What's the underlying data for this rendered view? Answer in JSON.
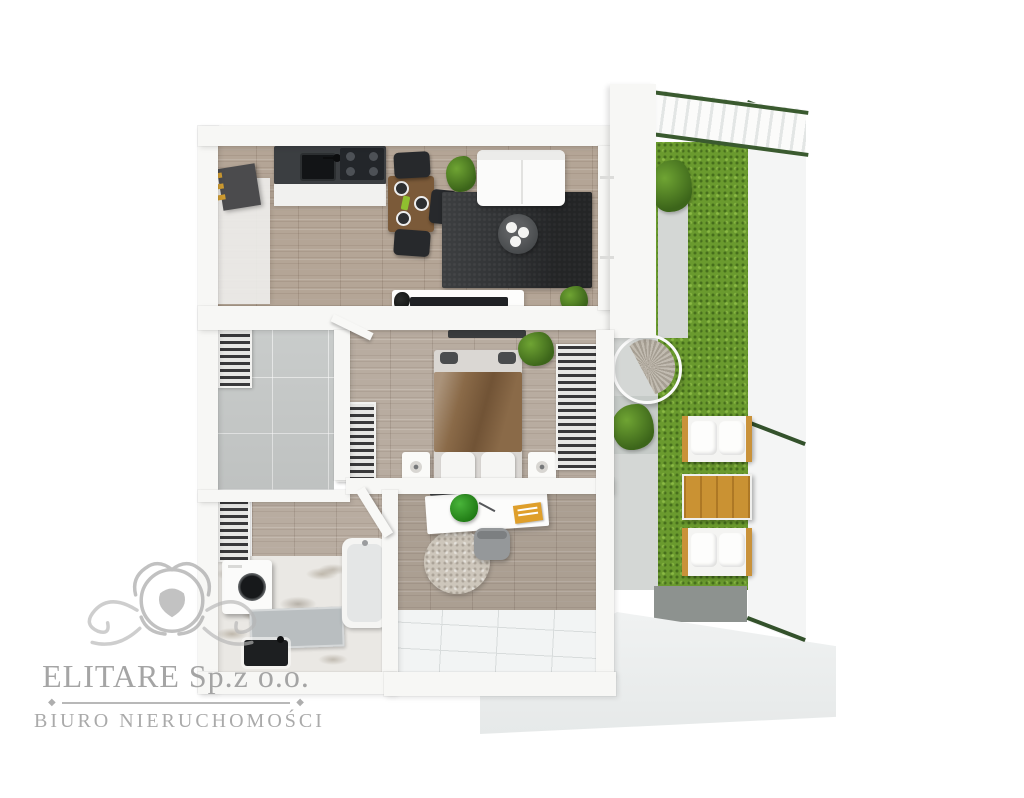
{
  "image": {
    "type": "3d-floorplan-top-view",
    "description": "Rendered top-down 3D floor plan of a one-bedroom apartment with side garden terrace and mesh fence"
  },
  "watermark": {
    "logo": "lion-crest-logo",
    "company": "ELITARE Sp.z o.o.",
    "tagline": "BIURO NIERUCHOMOŚCI",
    "divider_glyph": "◆",
    "text_color": "#a2a2a2"
  },
  "palette": {
    "background": "#ffffff",
    "walls": "#f7f7f5",
    "wood_floor": "#b4a596",
    "hall_tile": "#c9cccb",
    "marble_floor": "#eae8e4",
    "terrace_tile": "#f2f4f4",
    "dark_rug": "#313335",
    "kitchen_counter": "#3b3e41",
    "grass": "#6a9a2e",
    "concrete_path": "#d4d7d5",
    "dark_path": "#8d928f",
    "outdoor_wood": "#ca9233",
    "fence_post_green": "#33512b",
    "blanket_brown": "#8a6a48",
    "accent_gold": "#cf9c31"
  },
  "scene": {
    "rooms": [
      "kitchen",
      "living-room",
      "bedroom",
      "hallway",
      "bathroom",
      "office",
      "terrace",
      "garden"
    ],
    "kitchen": [
      "dark-countertop",
      "sink",
      "cooktop",
      "bar-cabinet",
      "dining-table",
      "dining-chairs",
      "plant"
    ],
    "living_room": [
      "white-sofa",
      "dark-area-rug",
      "round-coffee-table",
      "tv-console",
      "tv",
      "plants"
    ],
    "bedroom": [
      "double-bed",
      "brown-blanket",
      "pillows",
      "nightstands",
      "open-wardrobes",
      "plant",
      "soundbar"
    ],
    "hallway": [
      "closet-shelves",
      "doors",
      "gray-tile-floor"
    ],
    "bathroom": [
      "washing-machine",
      "shower-tray",
      "bathtub",
      "black-sink",
      "marble-floor"
    ],
    "office": [
      "white-desk",
      "desk-plant",
      "orange-notebook",
      "desk-chair",
      "round-rug"
    ],
    "terrace": [
      "white-floor-tiles"
    ],
    "garden": [
      "lawn",
      "concrete-path",
      "hanging-egg-chair",
      "outdoor-sofa",
      "outdoor-sofa",
      "wooden-coffee-table",
      "shrub",
      "palm-plant",
      "mesh-fence",
      "pergola",
      "stone-slab"
    ]
  }
}
